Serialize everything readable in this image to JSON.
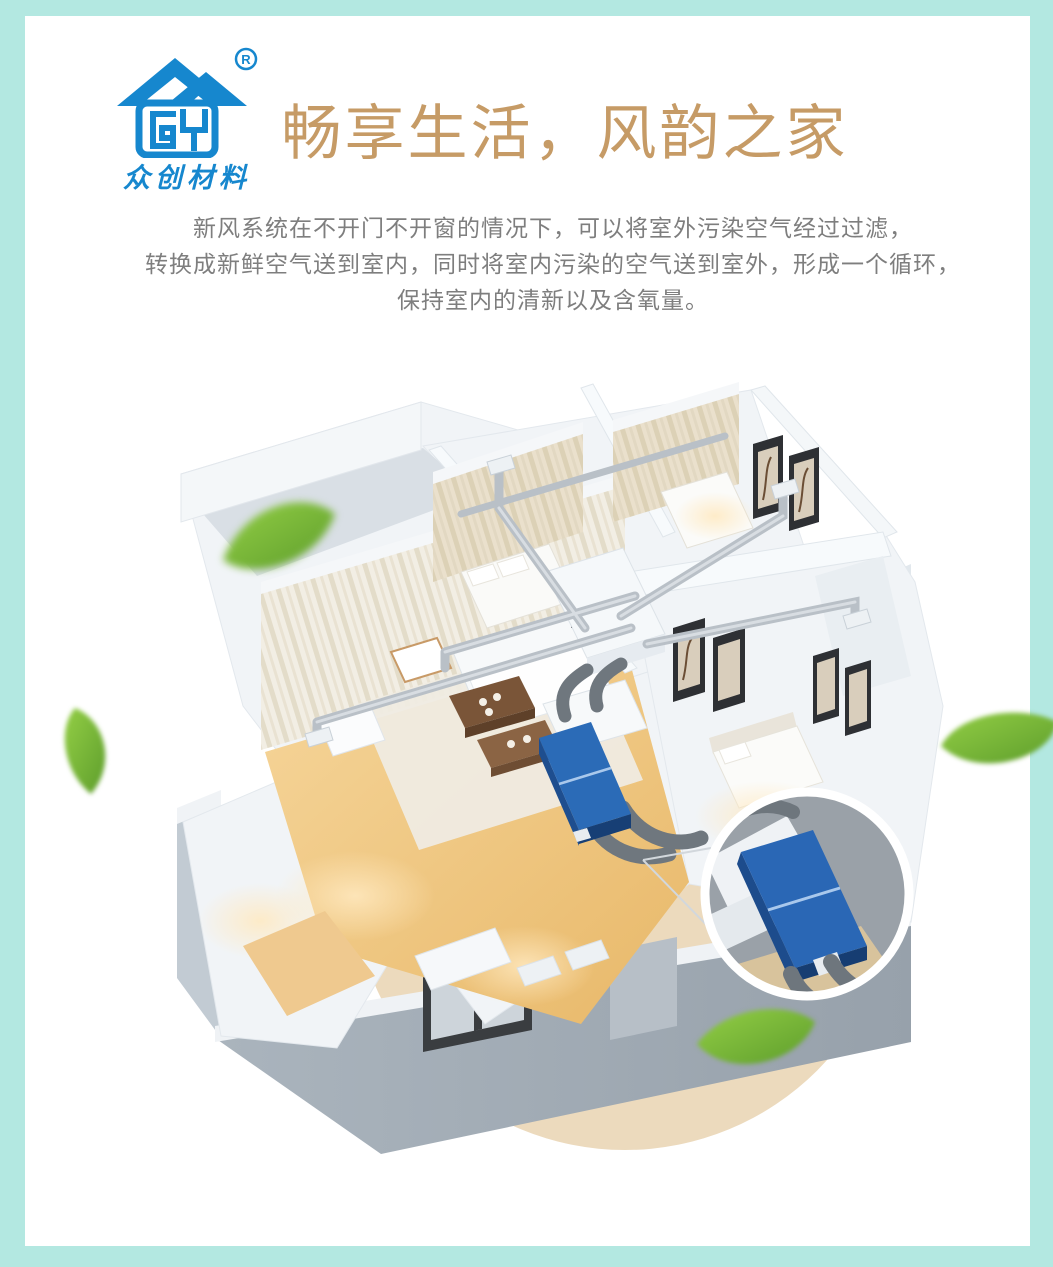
{
  "page": {
    "background_color": "#FFFFFF",
    "border_color": "#B3E8E1"
  },
  "logo": {
    "company_name": "众创材料",
    "registered_mark": "R",
    "brand_color": "#1687CE",
    "icon": "house-logo-icon"
  },
  "hero": {
    "title": "畅享生活，风韵之家",
    "title_color": "#C69B66",
    "description_line1": "新风系统在不开门不开窗的情况下，可以将室外污染空气经过过滤，",
    "description_line2": "转换成新鲜空气送到室内，同时将室内污染的空气送到室外，形成一个循环，",
    "description_line3": "保持室内的清新以及含氧量。",
    "description_color": "#7E7E7E"
  },
  "illustration": {
    "subject": "3D isometric apartment cutaway with fresh air ventilation system",
    "backdrop_circle_color": "#ECDABD",
    "leaf_color": "#7FBF3C",
    "ventilation_unit_color": "#2A67B5",
    "duct_color": "#B9C0C7",
    "wall_color": "#F1F4F7",
    "wood_floor_color": "#EFC98F",
    "exterior_wall_color": "#A2ACB5",
    "inset": {
      "shape": "circle",
      "border_color": "#FFFFFF",
      "content": "heat-recovery-ventilator close-up with ducts"
    }
  }
}
